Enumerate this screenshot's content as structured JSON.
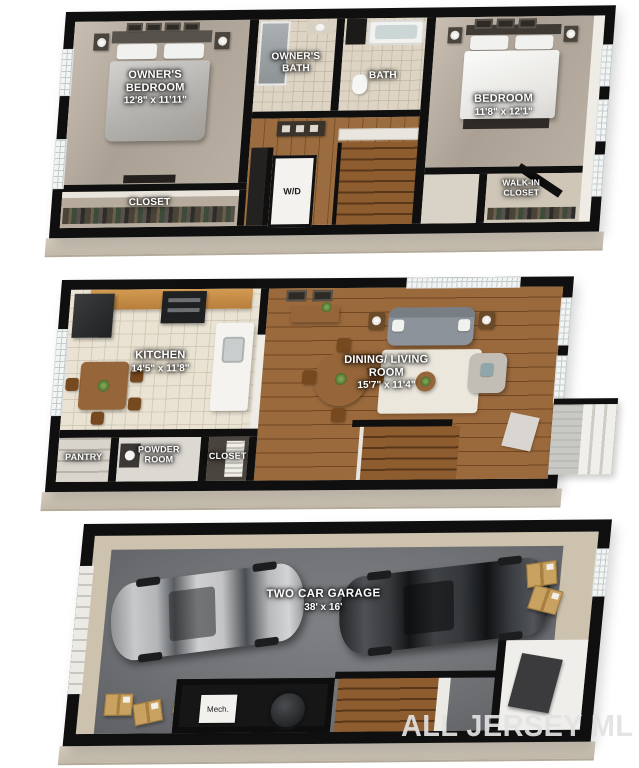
{
  "upper_floor": {
    "owners_bedroom": {
      "name": "OWNER'S BEDROOM",
      "dims": "12'8\" x 11'11\""
    },
    "owners_bath": {
      "name": "OWNER'S BATH"
    },
    "bath": {
      "name": "BATH"
    },
    "bedroom": {
      "name": "BEDROOM",
      "dims": "11'8\" x 12'1\""
    },
    "closet": {
      "name": "CLOSET"
    },
    "washer_dryer": {
      "name": "W/D"
    },
    "walk_in_closet": {
      "name": "WALK-IN CLOSET"
    }
  },
  "main_floor": {
    "kitchen": {
      "name": "KITCHEN",
      "dims": "14'5\" x 11'8\""
    },
    "dining_living": {
      "name": "DINING/ LIVING ROOM",
      "dims": "15'7\" x 11'4\""
    },
    "pantry": {
      "name": "PANTRY"
    },
    "powder_room": {
      "name": "POWDER ROOM"
    },
    "closet": {
      "name": "CLOSET"
    }
  },
  "garage_floor": {
    "garage": {
      "name": "TWO CAR GARAGE",
      "dims": "38' x 16'"
    },
    "mech": {
      "name": "Mech."
    }
  },
  "watermark": {
    "text": "ALL JERSEY ML"
  },
  "colors": {
    "wall": "#0f0f0f",
    "foundation": "#cfc5b6",
    "wood_floor": "#8e5c30",
    "carpet": "#aba094",
    "garage_concrete": "#717377",
    "label_text": "#ffffff",
    "watermark": "rgba(226,226,226,0.92)"
  }
}
